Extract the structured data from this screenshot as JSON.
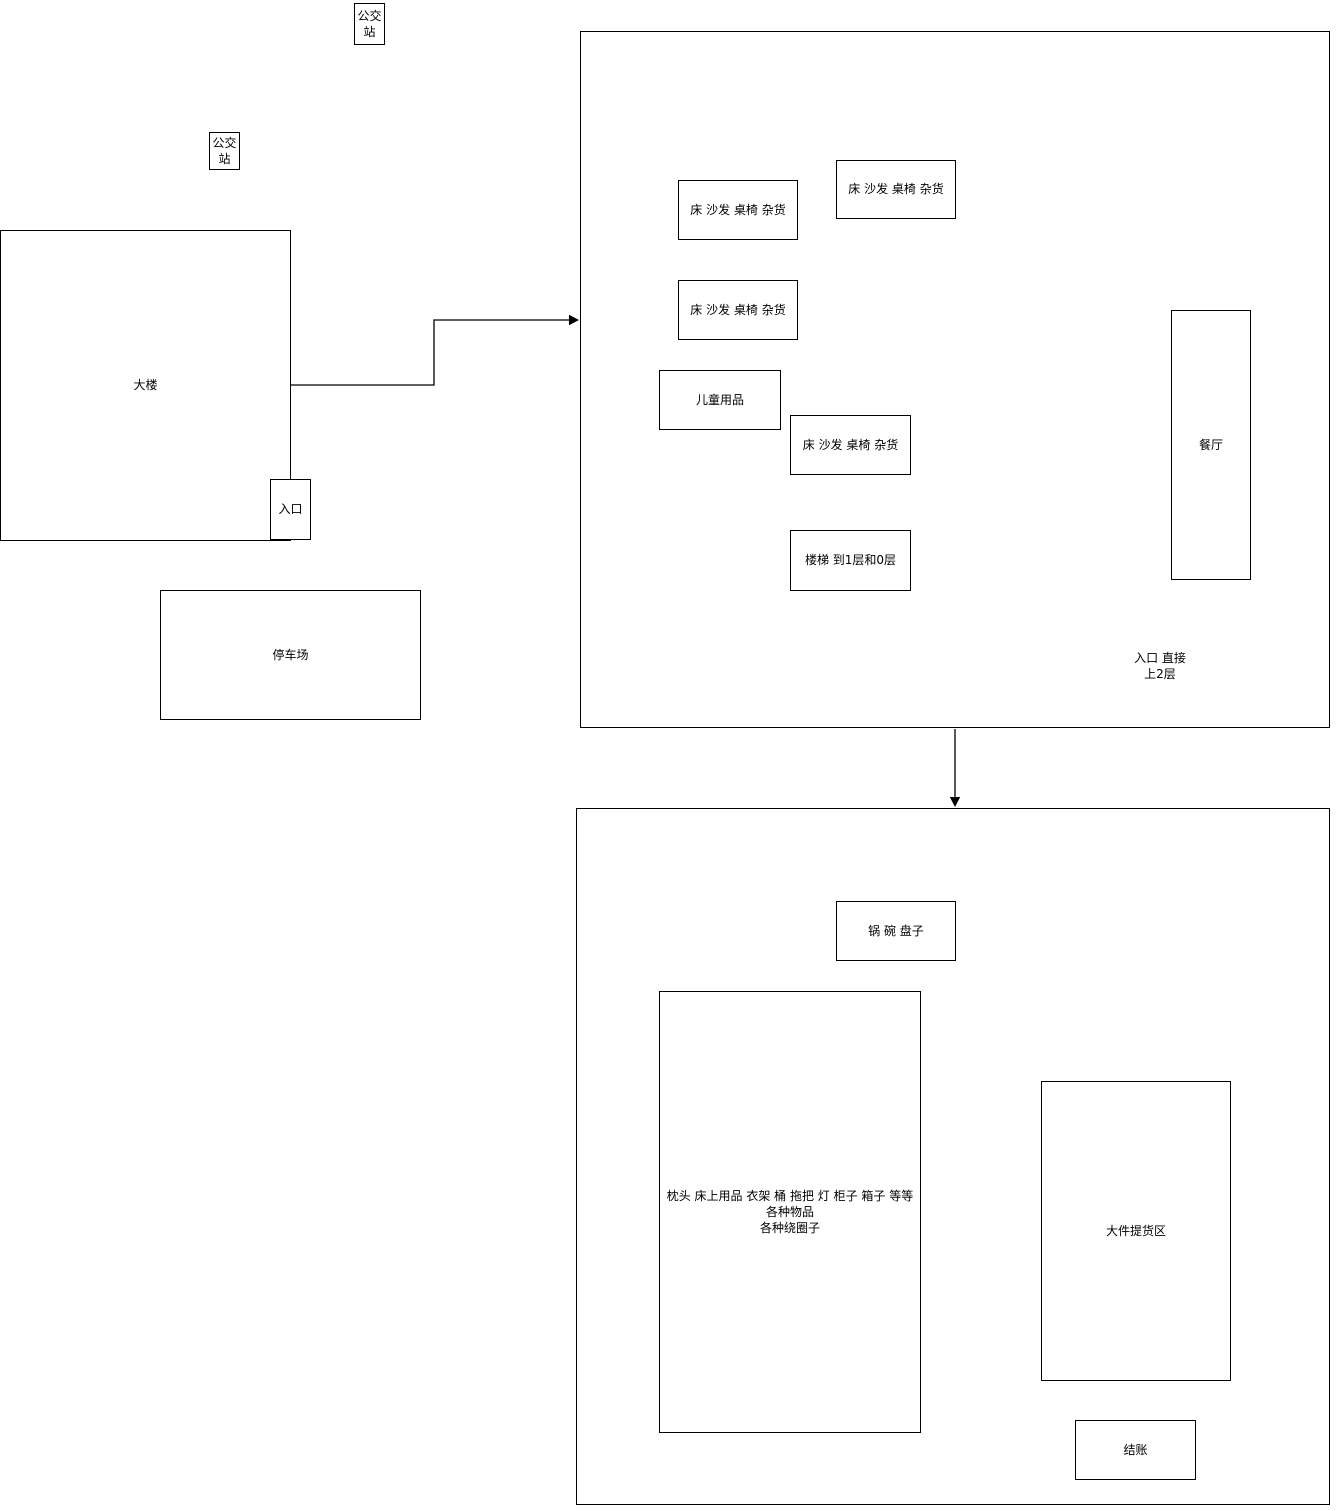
{
  "bus_stops": [
    {
      "label": "公交站"
    },
    {
      "label": "公交站"
    }
  ],
  "building": {
    "label": "大楼",
    "entrance_label": "入口"
  },
  "parking": {
    "label": "停车场"
  },
  "upper_floor": {
    "areas": {
      "bed1": {
        "label": "床 沙发 桌椅 杂货"
      },
      "bed2": {
        "label": "床 沙发 桌椅 杂货"
      },
      "bed3": {
        "label": "床 沙发 桌椅 杂货"
      },
      "kids": {
        "label": "儿童用品"
      },
      "bed4": {
        "label": "床 沙发 桌椅 杂货"
      },
      "stairs": {
        "label": "楼梯 到1层和0层"
      },
      "restaurant": {
        "label": "餐厅"
      }
    },
    "entrance_note": "入口 直接\n上2层"
  },
  "lower_floor": {
    "areas": {
      "kitchenware": {
        "label": "锅 碗 盘子"
      },
      "household": {
        "label": "枕头 床上用品 衣架 桶 拖把 灯 柜子 箱子 等等各种物品\n各种绕圈子"
      },
      "pickup": {
        "label": "大件提货区"
      },
      "checkout": {
        "label": "结账"
      }
    }
  },
  "colors": {
    "stroke": "#000000",
    "background": "#ffffff"
  }
}
